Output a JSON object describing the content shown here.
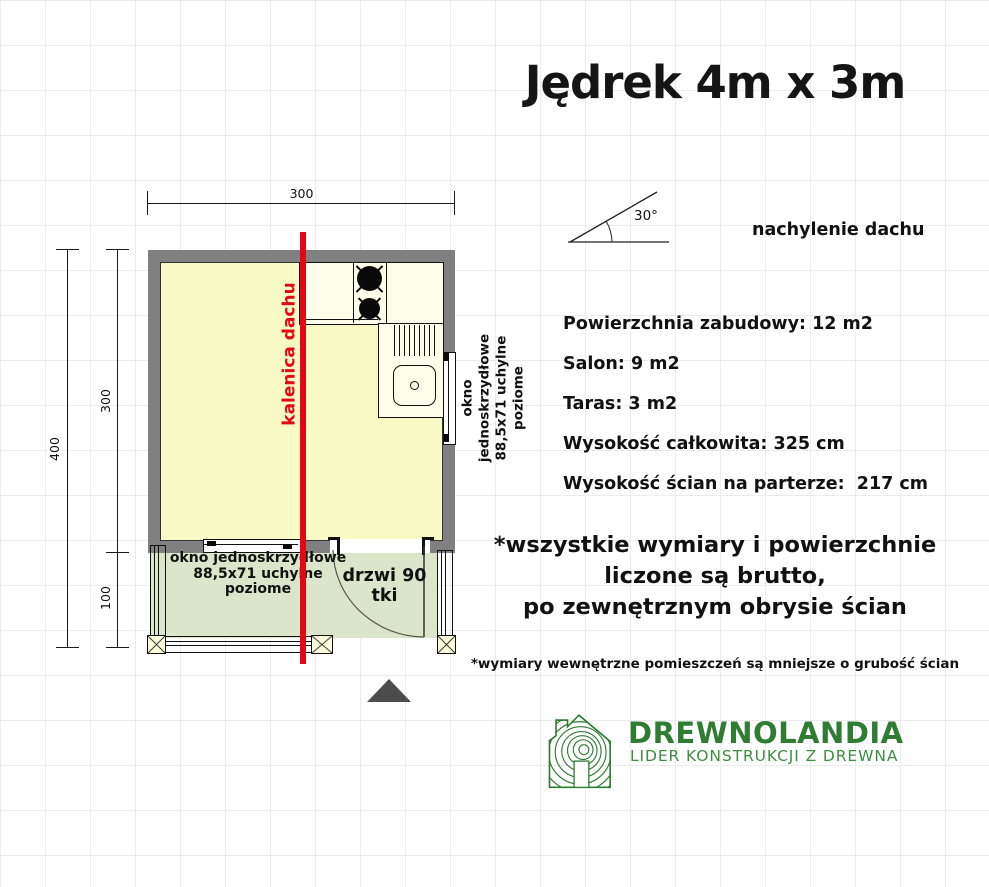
{
  "title": "Jędrek 4m x 3m",
  "roof_diagram": {
    "angle_label": "30°",
    "caption": "nachylenie dachu"
  },
  "dimensions": {
    "top": "300",
    "left_total": "400",
    "left_room": "300",
    "left_terrace": "100"
  },
  "plan_labels": {
    "ridge": "kalenica dachu",
    "window_right": [
      "okno jednoskrzydłowe",
      "88,5x71 uchylne",
      "poziome"
    ],
    "window_bottom": [
      "okno jednoskrzydłowe",
      "88,5x71 uchylne",
      "poziome"
    ],
    "door": "drzwi 90 tki"
  },
  "specs": [
    "Powierzchnia zabudowy: 12 m2",
    "Salon: 9 m2",
    "Taras: 3 m2",
    "Wysokość całkowita: 325 cm",
    "Wysokość ścian na parterze:  217 cm"
  ],
  "notes": {
    "big": [
      "*wszystkie wymiary i powierzchnie",
      "liczone są brutto,",
      "po zewnętrznym obrysie ścian"
    ],
    "small": "*wymiary wewnętrzne pomieszczeń są mniejsze o grubość ścian"
  },
  "logo": {
    "brand": "DREWNOLANDIA",
    "tagline": "LIDER KONSTRUKCJI Z DREWNA"
  },
  "colors": {
    "ridge-red": "#e30613",
    "wall-gray": "#808080",
    "floor-yellow": "#f9f9c5",
    "counter-cream": "#fdfdea",
    "terrace-green": "#dbe5c9",
    "logo-green": "#2e7d32",
    "logo-green-light": "#3e8e41",
    "grid-gray": "#ececec"
  }
}
